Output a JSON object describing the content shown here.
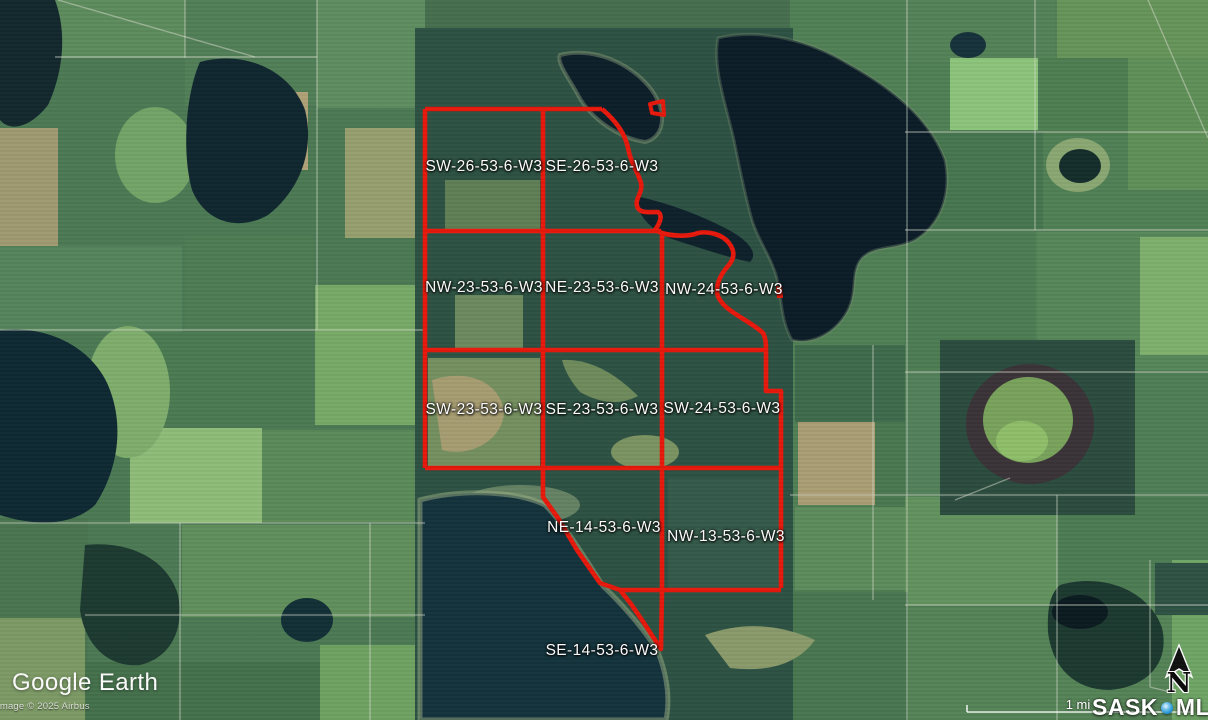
{
  "branding": {
    "logo": "Google Earth",
    "attribution": "Image © 2025 Airbus"
  },
  "map_overlay": {
    "scale_label": "1 mi",
    "north_label": "N",
    "watermark_sask": "SASK",
    "watermark_mls": "MLS",
    "watermark_reg": "®"
  },
  "parcels": [
    {
      "label": "SW-26-53-6-W3"
    },
    {
      "label": "SE-26-53-6-W3"
    },
    {
      "label": "NW-23-53-6-W3"
    },
    {
      "label": "NE-23-53-6-W3"
    },
    {
      "label": "NW-24-53-6-W3"
    },
    {
      "label": "SW-23-53-6-W3"
    },
    {
      "label": "SE-23-53-6-W3"
    },
    {
      "label": "SW-24-53-6-W3"
    },
    {
      "label": "NE-14-53-6-W3"
    },
    {
      "label": "NW-13-53-6-W3"
    },
    {
      "label": "SE-14-53-6-W3"
    }
  ],
  "colors": {
    "boundary_red": "#e8190c",
    "label_white": "#ffffff",
    "mls_dot_blue": "#2d9bd8"
  }
}
